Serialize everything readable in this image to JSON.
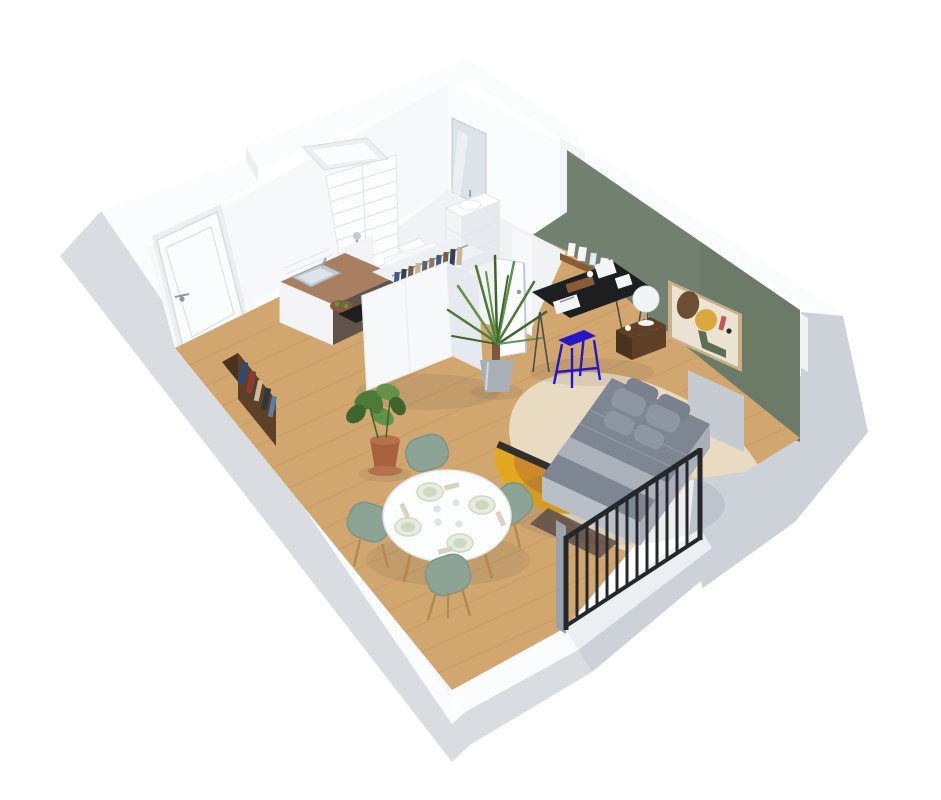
{
  "scene": {
    "title": "3D studio apartment floor plan",
    "description": "Isometric 3D rendered floor plan of a small studio apartment with entry, kitchen, bathroom, wardrobe, desk, bed, dining table and balcony railing",
    "rooms": [
      {
        "name": "entry-kitchen",
        "items": [
          "entry-door",
          "kitchen-counter",
          "kitchen-sink",
          "cooktop",
          "fruit-bowl",
          "bookshelf"
        ]
      },
      {
        "name": "bathroom",
        "items": [
          "tiled-shower-wall",
          "shower-column",
          "skylight-window",
          "toilet",
          "vanity-unit",
          "mirror",
          "open-bathroom-door"
        ]
      },
      {
        "name": "living-sleeping",
        "items": [
          "wardrobe-with-clothes",
          "potted-plant",
          "palm-plant",
          "black-desk",
          "blue-stool",
          "wall-shelf",
          "abstract-artwork",
          "nightstand",
          "ball-lamp",
          "double-bed",
          "pillows",
          "yellow-half-rug",
          "round-beige-rug",
          "doormat",
          "round-dining-table",
          "dining-chairs",
          "balcony-railing",
          "green-accent-wall"
        ]
      }
    ]
  },
  "colors": {
    "bg": "#ffffff",
    "ext_gray": "#cdd2d9",
    "ext_gray2": "#d9dde2",
    "cap_white": "#fbfcfd",
    "wall_white": "#f6f8fa",
    "wall_shadow": "#eceff2",
    "wall_step": "#f1f3f6",
    "green_wall": "#71806f",
    "green_dark": "#66755f",
    "floor_wood": "#d2a76f",
    "floor_line": "#bf9258",
    "bath_floor": "#f1f2f4",
    "tile_line": "#e2e6ea",
    "counter_wood": "#a97f62",
    "cabinet_white": "#f2f4f6",
    "cabinet_dark": "#60544a",
    "steel": "#c3c9cf",
    "steel_dark": "#9aa2ab",
    "fixture_white": "#fdfdfe",
    "mirror_glass": "#dce3e9",
    "wardrobe_white": "#f7f8fa",
    "wardrobe_side": "#e6e9ee",
    "wardrobe_inner": "#eef0f3",
    "clothes_1": "#43597e",
    "clothes_2": "#7a5c3e",
    "clothes_3": "#c7b394",
    "clothes_4": "#5d6470",
    "clothes_5": "#32405c",
    "clothes_6": "#8a7a5c",
    "plant_green": "#4e7a38",
    "plant_mid": "#63924a",
    "plant_dark": "#3e662c",
    "pot_terracotta": "#a8603f",
    "pot_terracotta2": "#b4714d",
    "pot_steel": "#a9afb6",
    "trunk_brown": "#7a5a3b",
    "desk_black": "#1d1e20",
    "leg_gray": "#4a4c50",
    "stool_blue": "#2517c7",
    "shelf_wood": "#8a5c36",
    "white_obj": "#f4f5f7",
    "art_frame": "#c9b089",
    "art_bg": "#ece3d2",
    "art_brown": "#6b4e33",
    "art_yellow": "#dca83e",
    "art_red": "#c4565a",
    "art_green": "#5c6e58",
    "art_black": "#2e2a28",
    "nightstand_wood": "#5d4026",
    "nightstand_dark": "#4a331e",
    "lamp_white": "#f2f3f5",
    "headboard": "#c6cbd2",
    "duvet": "#7e8692",
    "sheet_fold": "#aab1bb",
    "bed_base": "#b9bfc7",
    "bed_side": "#a9afb8",
    "pillow": "#8d96a2",
    "pillow_dark": "#78818d",
    "rug_round": "#eadfc9",
    "rug_yellow": "#e2a81f",
    "rug_orange": "#cd8a2a",
    "rug_stripe": "#2f2f30",
    "doormat": "#6a564a",
    "chair_green": "#8ba495",
    "chair_edge": "#7b9488",
    "wood_leg": "#b5894f",
    "table_white": "#fcfdfd",
    "table_edge": "#e2e6ea",
    "plate_rim": "#e8ebe2",
    "plate_in": "#cfd9c2",
    "napkin": "#d9d2bd",
    "glass_gray": "#dfe3e6",
    "rail_black": "#26272b",
    "door_white": "#fbfcfd",
    "door_line": "#d8dce2",
    "handle_gray": "#8f969e",
    "book_1": "#2e4a7a",
    "book_2": "#8c3a34",
    "book_3": "#cabb9e",
    "book_4": "#33363d",
    "book_5": "#5a7ca6",
    "shadow": "rgba(30,40,60,0.08)"
  }
}
